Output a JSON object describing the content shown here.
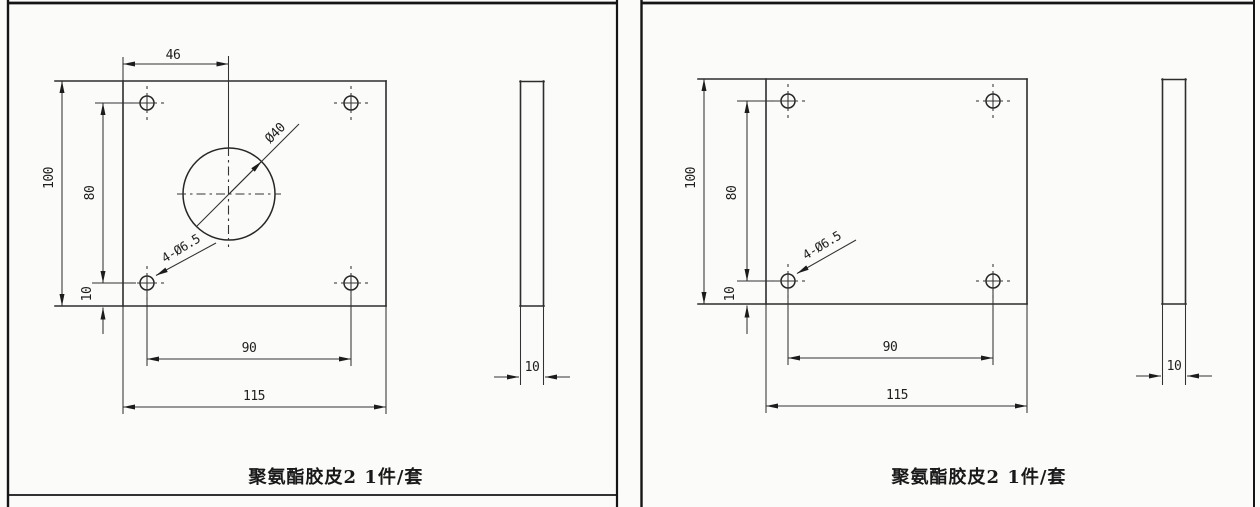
{
  "page": {
    "background": "#fbfbf9",
    "line_color": "#2d2d2d",
    "text_color": "#1e1e1e"
  },
  "panels": [
    {
      "id": "left-sheet",
      "caption": "聚氨酯胶皮2 1件/套",
      "front_view": {
        "width_label": "115",
        "height_label": "100",
        "hole_spacing_h_label": "90",
        "hole_spacing_v_label": "80",
        "bottom_offset_label": "10",
        "center_offset_label": "46",
        "center_hole_label": "Ø40",
        "corner_holes_label": "4-Ø6.5"
      },
      "side_view": {
        "thickness_label": "10"
      }
    },
    {
      "id": "right-sheet",
      "caption": "聚氨酯胶皮2 1件/套",
      "front_view": {
        "width_label": "115",
        "height_label": "100",
        "hole_spacing_h_label": "90",
        "hole_spacing_v_label": "80",
        "bottom_offset_label": "10",
        "corner_holes_label": "4-Ø6.5"
      },
      "side_view": {
        "thickness_label": "10"
      }
    }
  ]
}
